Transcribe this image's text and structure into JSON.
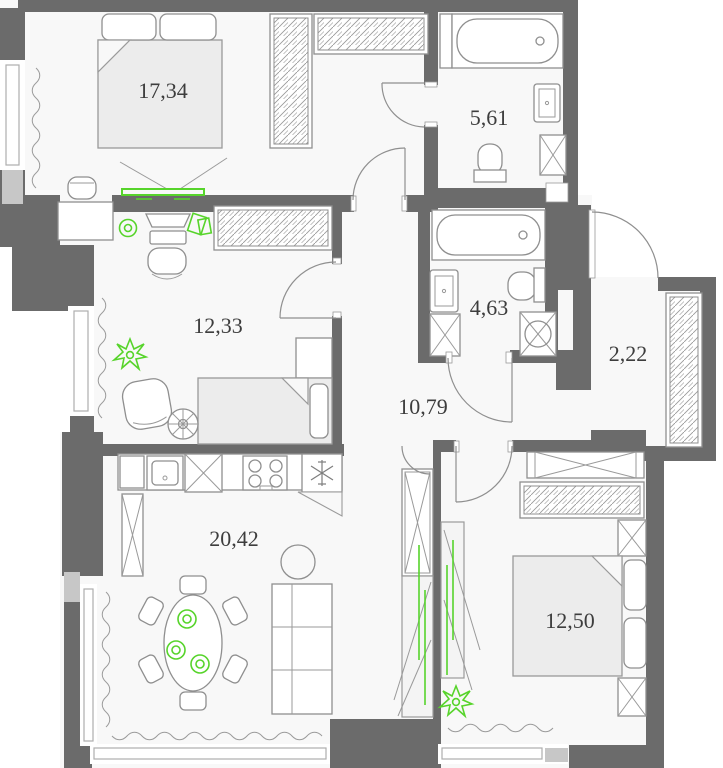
{
  "plan": {
    "title": "apartment-floor-plan",
    "accent_color": "#57d42b",
    "wall_color": "#6b6b6b",
    "floor_color": "#f8f8f8",
    "label_color": "#3d3d3d",
    "rooms": [
      {
        "id": "bedroom-main",
        "area": "17,34"
      },
      {
        "id": "bathroom-ensuite",
        "area": "5,61"
      },
      {
        "id": "room-second",
        "area": "12,33"
      },
      {
        "id": "bathroom-guest",
        "area": "4,63"
      },
      {
        "id": "entry-wardrobe",
        "area": "2,22"
      },
      {
        "id": "hallway",
        "area": "10,79"
      },
      {
        "id": "kitchen-living",
        "area": "20,42"
      },
      {
        "id": "bedroom-third",
        "area": "12,50"
      }
    ],
    "furniture": {
      "bedroom-main": [
        "double-bed",
        "wardrobe",
        "wardrobe",
        "tv",
        "vanity-desk",
        "pouf",
        "curtain",
        "window"
      ],
      "bathroom-ensuite": [
        "bathtub",
        "sink",
        "toilet",
        "shaft"
      ],
      "room-second": [
        "desk",
        "chair",
        "wardrobe",
        "single-bed",
        "nightstand",
        "armchair",
        "round-table",
        "plant",
        "curtain",
        "window"
      ],
      "bathroom-guest": [
        "bathtub",
        "sink",
        "toilet",
        "shaft",
        "washing-machine"
      ],
      "entry-wardrobe": [
        "wardrobe"
      ],
      "kitchen-living": [
        "kitchen-sink",
        "cabinet",
        "stove",
        "fridge",
        "tall-cabinet",
        "dining-table",
        "chairs",
        "plates",
        "shelf-unit",
        "plant-circle",
        "sliding-wardrobe",
        "mirror-wardrobe",
        "curtains",
        "windows"
      ],
      "bedroom-third": [
        "double-bed",
        "dresser",
        "wardrobe",
        "shaft",
        "mirror-wardrobe",
        "plant",
        "curtain",
        "window"
      ]
    }
  }
}
